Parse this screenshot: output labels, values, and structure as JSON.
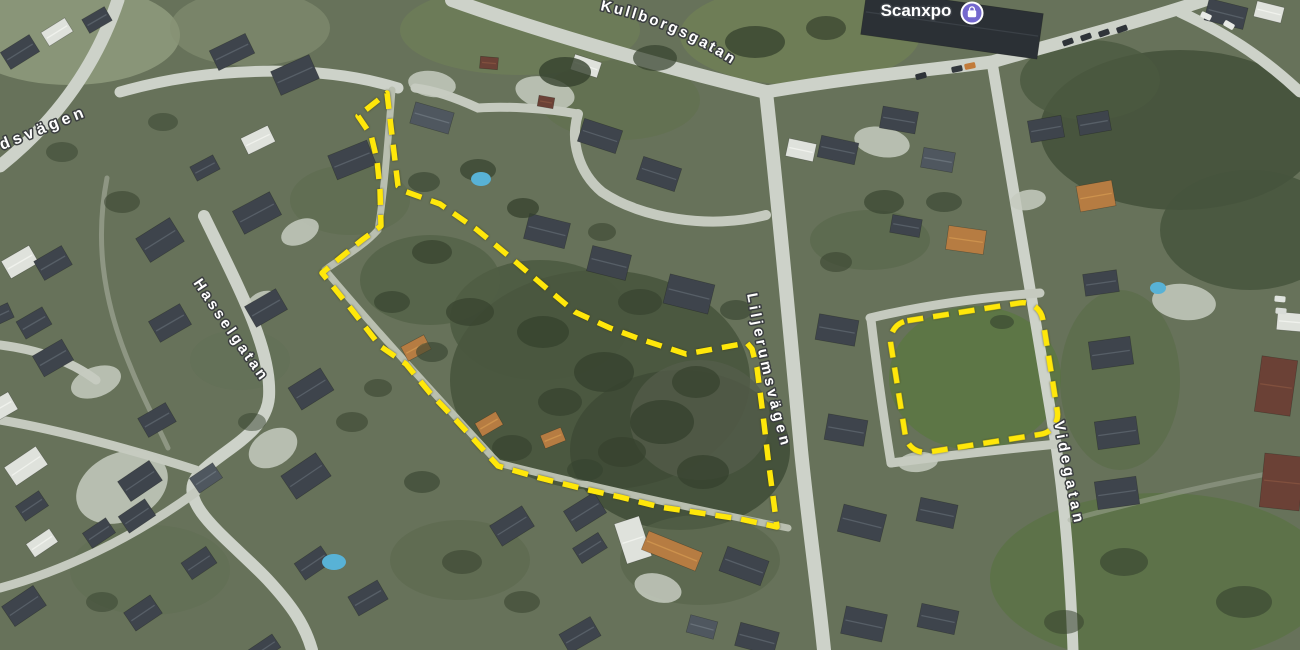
{
  "map": {
    "road_labels": [
      {
        "id": "dsv",
        "text": "dsvägen"
      },
      {
        "id": "kull",
        "text": "Kullborgsgatan"
      },
      {
        "id": "hassel",
        "text": "Hasselgatan"
      },
      {
        "id": "lilje",
        "text": "Liljerumsvägen"
      },
      {
        "id": "vide",
        "text": "Videgatan"
      }
    ],
    "poi": {
      "name": "Scanxpo",
      "icon": "shopping-bag-icon",
      "icon_color": "#7468CE"
    },
    "annotation": {
      "color": "#FFE70A",
      "dash": "16 10",
      "stroke_width": 5.5,
      "main_zone_points": "387,93 398,186 404,191 440,204 476,229 510,257 545,287 575,312 610,328 640,339 686,354 747,343 752,349 757,368 763,415 769,466 777,527 740,519 700,513 660,507 620,497 580,488 540,478 498,466 478,444 455,419 430,393 406,364 380,346 352,310 322,273 340,258 362,240 381,226 380,190 377,160 371,135 358,116",
      "field_zone": {
        "x": 897,
        "y": 311,
        "w": 154,
        "h": 133,
        "rx": 20,
        "rotate": "-9 974 377"
      }
    },
    "palette": {
      "base": "#67725a",
      "tree": "#36422e",
      "driveway": "#c6cbbf",
      "pool": "#58b2d6",
      "roofs": {
        "d": [
          "#3e444c",
          "#5a626b"
        ],
        "s": [
          "#4f575f",
          "#6a737b"
        ],
        "w": [
          "#dfe2dc",
          "#f2f4ef"
        ],
        "o": [
          "#b67c42",
          "#d0954f"
        ],
        "r": [
          "#6b4136",
          "#84523f"
        ],
        "k": [
          "#2b3035",
          "#3c4248"
        ]
      }
    }
  },
  "features": {
    "terrain": [
      [
        70,
        35,
        110,
        50,
        "#8d997b",
        0.9
      ],
      [
        250,
        28,
        80,
        38,
        "#859173",
        0.6
      ],
      [
        520,
        30,
        120,
        45,
        "#6e7d57",
        0.8
      ],
      [
        800,
        35,
        120,
        50,
        "#6f7e55",
        0.9
      ],
      [
        975,
        378,
        86,
        72,
        "#5d7646",
        1
      ],
      [
        1160,
        578,
        170,
        85,
        "#5c7247",
        0.9
      ],
      [
        620,
        100,
        80,
        40,
        "#62704e",
        0.7
      ],
      [
        600,
        380,
        150,
        110,
        "#47543c",
        0.85
      ],
      [
        680,
        450,
        110,
        80,
        "#3d4a34",
        0.8
      ],
      [
        540,
        320,
        90,
        60,
        "#4a573e",
        0.8
      ],
      [
        430,
        280,
        70,
        45,
        "#515f45",
        0.7
      ],
      [
        1180,
        130,
        140,
        80,
        "#45523b",
        0.9
      ],
      [
        1250,
        230,
        90,
        60,
        "#47553d",
        0.85
      ],
      [
        1090,
        80,
        70,
        40,
        "#4b5940",
        0.8
      ],
      [
        870,
        240,
        60,
        30,
        "#5a684b",
        0.7
      ],
      [
        700,
        560,
        80,
        45,
        "#57644a",
        0.6
      ],
      [
        460,
        560,
        70,
        40,
        "#5b694c",
        0.6
      ],
      [
        150,
        570,
        80,
        45,
        "#606e52",
        0.5
      ],
      [
        350,
        200,
        60,
        35,
        "#5e6c4e",
        0.6
      ],
      [
        700,
        420,
        70,
        60,
        "#555e4b",
        0.7
      ],
      [
        240,
        360,
        50,
        30,
        "#626f55",
        0.5
      ],
      [
        1120,
        380,
        60,
        90,
        "#586c46",
        0.6
      ]
    ],
    "roads": [
      {
        "d": "M 118,0 C 102,48 70,110 0,166",
        "w": 13,
        "c": "#cdd2c9"
      },
      {
        "d": "M 120,92 C 210,66 320,64 398,88",
        "w": 11,
        "c": "#cdd2c9"
      },
      {
        "d": "M 452,0 C 530,28 650,64 766,92",
        "w": 14,
        "c": "#cdd2c9"
      },
      {
        "d": "M 766,92 C 860,76 930,70 992,62",
        "w": 13,
        "c": "#cdd2c9"
      },
      {
        "d": "M 992,62 C 1060,42 1140,22 1205,0",
        "w": 13,
        "c": "#cdd2c9"
      },
      {
        "d": "M 1180,12 C 1235,38 1268,62 1300,92",
        "w": 11,
        "c": "#cdd2c9"
      },
      {
        "d": "M 766,92 C 778,200 790,330 801,450 C 808,520 818,590 824,650",
        "w": 14,
        "c": "#cdd2c9"
      },
      {
        "d": "M 992,62 C 1008,160 1032,300 1052,420 C 1062,480 1070,560 1073,650",
        "w": 11,
        "c": "#cdd2c9"
      },
      {
        "d": "M 870,318 C 925,305 985,297 1040,293",
        "w": 9,
        "c": "#c5cabf"
      },
      {
        "d": "M 871,320 C 877,370 884,420 891,463",
        "w": 9,
        "c": "#c5cabf"
      },
      {
        "d": "M 891,463 C 945,456 1005,449 1058,444",
        "w": 9,
        "c": "#c5cabf"
      },
      {
        "d": "M 204,216 C 240,290 272,350 269,397 C 266,436 216,452 196,478 C 178,505 230,540 268,580 C 292,606 305,625 312,650",
        "w": 12,
        "c": "#cdd2c9"
      },
      {
        "d": "M 196,470 C 140,452 60,430 0,420",
        "w": 9,
        "c": "#c5cabf"
      },
      {
        "d": "M 196,492 C 130,540 60,572 0,588",
        "w": 9,
        "c": "#c5cabf"
      },
      {
        "d": "M 392,90 C 388,140 384,195 378,230 C 362,248 338,260 325,270",
        "w": 7,
        "c": "#b9bfb0"
      },
      {
        "d": "M 325,270 C 380,335 440,400 498,463",
        "w": 7,
        "c": "#b9bfb0"
      },
      {
        "d": "M 498,463 C 580,484 690,508 788,528",
        "w": 7,
        "c": "#b9bfb0"
      },
      {
        "d": "M 766,215 C 710,230 640,218 602,192 C 578,172 570,140 578,114",
        "w": 10,
        "c": "#c5cabf"
      },
      {
        "d": "M 578,114 C 545,108 505,106 478,108 C 452,96 432,90 415,88",
        "w": 9,
        "c": "#c5cabf"
      },
      {
        "d": "M 0,345 C 40,350 72,362 96,380",
        "w": 9,
        "c": "#c5cabf"
      },
      {
        "d": "M 107,178 C 96,235 100,295 131,368 C 142,396 156,422 168,448",
        "w": 5,
        "c": "#a9af9f",
        "o": 0.6
      },
      {
        "d": "M 1070,520 C 1150,498 1230,480 1300,468",
        "w": 5,
        "c": "#a9af9f",
        "o": 0.45
      }
    ],
    "patches": [
      [
        122,
        487,
        48,
        34,
        -25
      ],
      [
        96,
        382,
        26,
        15,
        -20
      ],
      [
        273,
        448,
        26,
        18,
        -30
      ],
      [
        545,
        93,
        30,
        16,
        12
      ],
      [
        432,
        84,
        24,
        13,
        8
      ],
      [
        882,
        142,
        28,
        15,
        10
      ],
      [
        658,
        588,
        24,
        14,
        15
      ],
      [
        300,
        232,
        20,
        12,
        -25
      ],
      [
        1184,
        302,
        32,
        18,
        6
      ],
      [
        262,
        302,
        16,
        10,
        -25
      ],
      [
        918,
        462,
        20,
        10,
        -5
      ],
      [
        1028,
        200,
        18,
        10,
        -10
      ]
    ],
    "houses": [
      [
        20,
        52,
        34,
        20,
        -32,
        "d"
      ],
      [
        57,
        32,
        28,
        16,
        -32,
        "w"
      ],
      [
        97,
        20,
        26,
        16,
        -30,
        "d"
      ],
      [
        232,
        52,
        40,
        22,
        -26,
        "d"
      ],
      [
        295,
        75,
        42,
        26,
        -24,
        "d"
      ],
      [
        258,
        140,
        30,
        18,
        -26,
        "w"
      ],
      [
        352,
        160,
        42,
        26,
        -22,
        "d"
      ],
      [
        205,
        168,
        26,
        16,
        -28,
        "d"
      ],
      [
        20,
        262,
        32,
        20,
        -30,
        "w"
      ],
      [
        53,
        263,
        32,
        22,
        -30,
        "d"
      ],
      [
        34,
        323,
        30,
        20,
        -30,
        "d"
      ],
      [
        53,
        358,
        34,
        24,
        -30,
        "d"
      ],
      [
        160,
        240,
        40,
        28,
        -32,
        "d"
      ],
      [
        170,
        323,
        36,
        24,
        -30,
        "d"
      ],
      [
        257,
        213,
        42,
        26,
        -28,
        "d"
      ],
      [
        266,
        308,
        36,
        24,
        -30,
        "d"
      ],
      [
        311,
        389,
        38,
        26,
        -32,
        "d"
      ],
      [
        157,
        420,
        32,
        22,
        -30,
        "d"
      ],
      [
        0,
        408,
        30,
        20,
        -30,
        "w"
      ],
      [
        0,
        315,
        24,
        16,
        -25,
        "d"
      ],
      [
        26,
        466,
        38,
        22,
        -34,
        "w"
      ],
      [
        32,
        506,
        28,
        18,
        -34,
        "d"
      ],
      [
        42,
        543,
        28,
        16,
        -34,
        "w"
      ],
      [
        24,
        606,
        38,
        24,
        -34,
        "d"
      ],
      [
        140,
        481,
        38,
        24,
        -34,
        "d"
      ],
      [
        137,
        516,
        32,
        20,
        -34,
        "d"
      ],
      [
        99,
        533,
        28,
        18,
        -34,
        "d"
      ],
      [
        143,
        613,
        32,
        22,
        -34,
        "d"
      ],
      [
        199,
        563,
        30,
        20,
        -34,
        "d"
      ],
      [
        206,
        478,
        28,
        18,
        -34,
        "s"
      ],
      [
        306,
        476,
        42,
        28,
        -34,
        "d"
      ],
      [
        313,
        563,
        32,
        20,
        -34,
        "d"
      ],
      [
        264,
        649,
        30,
        16,
        -34,
        "d"
      ],
      [
        368,
        598,
        34,
        22,
        -30,
        "d"
      ],
      [
        512,
        526,
        38,
        24,
        -32,
        "d"
      ],
      [
        585,
        512,
        36,
        24,
        -32,
        "d"
      ],
      [
        590,
        548,
        30,
        18,
        -32,
        "d"
      ],
      [
        633,
        540,
        26,
        42,
        -18,
        "w"
      ],
      [
        672,
        551,
        58,
        20,
        22,
        "o"
      ],
      [
        744,
        566,
        44,
        26,
        20,
        "d"
      ],
      [
        757,
        639,
        40,
        24,
        15,
        "d"
      ],
      [
        702,
        627,
        28,
        18,
        15,
        "s"
      ],
      [
        580,
        635,
        36,
        22,
        -30,
        "d"
      ],
      [
        416,
        348,
        26,
        16,
        -28,
        "o"
      ],
      [
        489,
        424,
        24,
        15,
        -30,
        "o"
      ],
      [
        553,
        438,
        22,
        14,
        -22,
        "o"
      ],
      [
        547,
        231,
        42,
        26,
        14,
        "d"
      ],
      [
        609,
        263,
        40,
        26,
        14,
        "d"
      ],
      [
        689,
        294,
        46,
        30,
        14,
        "d"
      ],
      [
        600,
        136,
        40,
        24,
        18,
        "d"
      ],
      [
        659,
        174,
        40,
        24,
        18,
        "d"
      ],
      [
        586,
        66,
        28,
        16,
        18,
        "w"
      ],
      [
        432,
        118,
        40,
        22,
        16,
        "s"
      ],
      [
        489,
        63,
        18,
        12,
        5,
        "r"
      ],
      [
        546,
        102,
        16,
        11,
        10,
        "r"
      ],
      [
        838,
        150,
        38,
        22,
        12,
        "d"
      ],
      [
        801,
        150,
        28,
        18,
        12,
        "w"
      ],
      [
        899,
        120,
        36,
        22,
        10,
        "d"
      ],
      [
        938,
        160,
        32,
        20,
        10,
        "s"
      ],
      [
        906,
        226,
        30,
        18,
        10,
        "d"
      ],
      [
        966,
        240,
        38,
        24,
        8,
        "o"
      ],
      [
        837,
        330,
        40,
        26,
        10,
        "d"
      ],
      [
        846,
        430,
        40,
        26,
        10,
        "d"
      ],
      [
        862,
        523,
        44,
        28,
        14,
        "d"
      ],
      [
        937,
        513,
        38,
        24,
        12,
        "d"
      ],
      [
        864,
        624,
        42,
        28,
        12,
        "d"
      ],
      [
        938,
        619,
        38,
        24,
        12,
        "d"
      ],
      [
        952,
        24,
        178,
        46,
        8,
        "k"
      ],
      [
        1226,
        14,
        40,
        22,
        14,
        "d"
      ],
      [
        1269,
        12,
        28,
        16,
        14,
        "w"
      ],
      [
        1046,
        129,
        34,
        22,
        -10,
        "d"
      ],
      [
        1094,
        123,
        32,
        20,
        -10,
        "d"
      ],
      [
        1096,
        196,
        36,
        26,
        -10,
        "o"
      ],
      [
        1101,
        283,
        34,
        22,
        -8,
        "d"
      ],
      [
        1111,
        353,
        42,
        28,
        -8,
        "d"
      ],
      [
        1117,
        433,
        42,
        28,
        -8,
        "d"
      ],
      [
        1117,
        493,
        42,
        28,
        -8,
        "d"
      ],
      [
        1276,
        386,
        36,
        56,
        8,
        "r"
      ],
      [
        1282,
        482,
        40,
        54,
        6,
        "r"
      ],
      [
        1292,
        322,
        30,
        18,
        5,
        "w"
      ]
    ],
    "trees": [
      [
        565,
        72,
        26,
        15,
        0.8
      ],
      [
        655,
        58,
        22,
        13,
        0.7
      ],
      [
        755,
        42,
        30,
        16,
        0.75
      ],
      [
        826,
        28,
        20,
        12,
        0.7
      ],
      [
        478,
        170,
        18,
        11,
        0.7
      ],
      [
        523,
        208,
        16,
        10,
        0.75
      ],
      [
        432,
        252,
        20,
        12,
        0.7
      ],
      [
        392,
        302,
        18,
        11,
        0.65
      ],
      [
        470,
        312,
        24,
        14,
        0.7
      ],
      [
        543,
        332,
        26,
        16,
        0.75
      ],
      [
        604,
        372,
        30,
        20,
        0.8
      ],
      [
        662,
        422,
        32,
        22,
        0.8
      ],
      [
        703,
        472,
        26,
        17,
        0.75
      ],
      [
        622,
        452,
        24,
        15,
        0.7
      ],
      [
        560,
        402,
        22,
        14,
        0.7
      ],
      [
        640,
        302,
        22,
        13,
        0.65
      ],
      [
        696,
        382,
        24,
        16,
        0.7
      ],
      [
        736,
        310,
        16,
        10,
        0.6
      ],
      [
        884,
        202,
        20,
        12,
        0.65
      ],
      [
        944,
        202,
        18,
        10,
        0.6
      ],
      [
        1002,
        322,
        12,
        7,
        0.6
      ],
      [
        836,
        262,
        16,
        10,
        0.55
      ],
      [
        122,
        202,
        18,
        11,
        0.55
      ],
      [
        62,
        152,
        16,
        10,
        0.5
      ],
      [
        163,
        122,
        15,
        9,
        0.5
      ],
      [
        352,
        422,
        16,
        10,
        0.55
      ],
      [
        422,
        482,
        18,
        11,
        0.6
      ],
      [
        252,
        422,
        14,
        9,
        0.5
      ],
      [
        102,
        602,
        16,
        10,
        0.5
      ],
      [
        462,
        562,
        20,
        12,
        0.55
      ],
      [
        522,
        602,
        18,
        11,
        0.55
      ],
      [
        1124,
        562,
        24,
        14,
        0.6
      ],
      [
        1244,
        602,
        28,
        16,
        0.6
      ],
      [
        1064,
        622,
        20,
        12,
        0.55
      ],
      [
        424,
        182,
        16,
        10,
        0.6
      ],
      [
        602,
        232,
        14,
        9,
        0.55
      ],
      [
        512,
        448,
        20,
        13,
        0.65
      ],
      [
        585,
        470,
        18,
        11,
        0.6
      ],
      [
        432,
        352,
        16,
        10,
        0.6
      ],
      [
        378,
        388,
        14,
        9,
        0.55
      ]
    ],
    "cars": [
      [
        921,
        76,
        -15,
        "#2e3338"
      ],
      [
        957,
        69,
        -12,
        "#33383d"
      ],
      [
        970,
        66,
        -12,
        "#c27b3a"
      ],
      [
        1068,
        42,
        -20,
        "#2e3338"
      ],
      [
        1086,
        37,
        -20,
        "#2e3338"
      ],
      [
        1104,
        33,
        -20,
        "#30353a"
      ],
      [
        1122,
        29,
        -20,
        "#2e3338"
      ],
      [
        1206,
        16,
        25,
        "#e8eae6"
      ],
      [
        1229,
        25,
        30,
        "#e8eae6"
      ],
      [
        1280,
        299,
        5,
        "#dfe3de"
      ],
      [
        1281,
        311,
        5,
        "#d8dcd7"
      ]
    ],
    "pools": [
      [
        481,
        179,
        10,
        7
      ],
      [
        334,
        562,
        12,
        8
      ],
      [
        1158,
        288,
        8,
        6
      ]
    ]
  }
}
